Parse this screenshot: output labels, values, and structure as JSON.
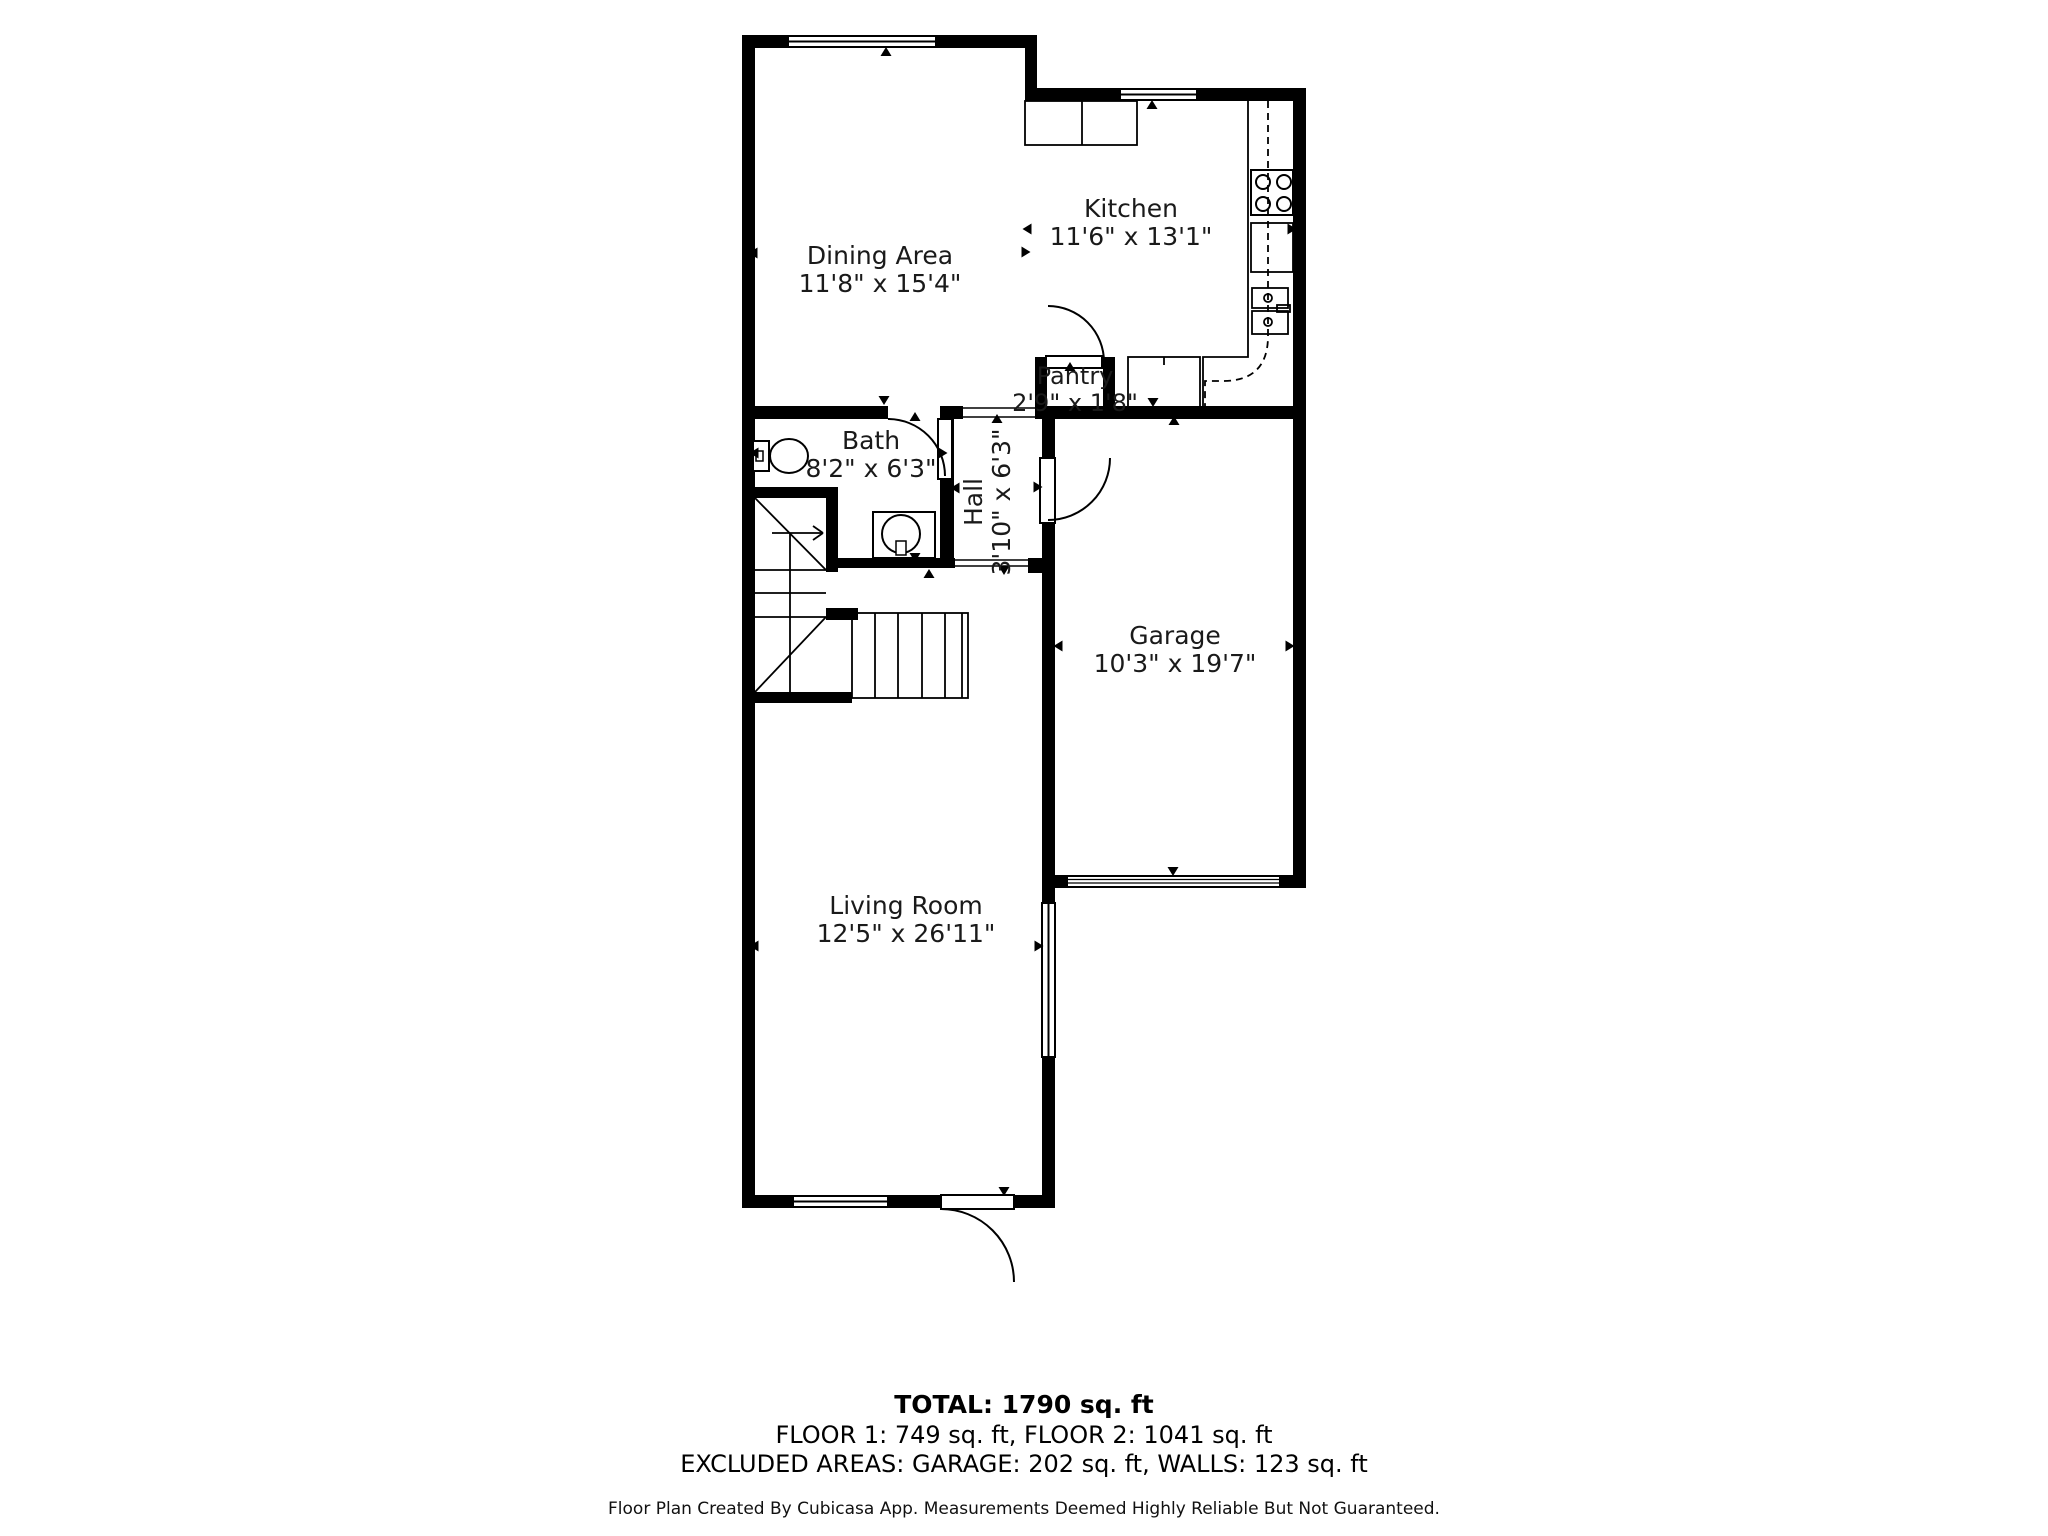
{
  "rooms": [
    {
      "name": "Dining Area",
      "dims": "11'8\" x 15'4\""
    },
    {
      "name": "Kitchen",
      "dims": "11'6\" x 13'1\""
    },
    {
      "name": "Pantry",
      "dims": "2'9\" x 1'8\""
    },
    {
      "name": "Bath",
      "dims": "8'2\" x 6'3\""
    },
    {
      "name": "Hall",
      "dims": "3'10\" x 6'3\""
    },
    {
      "name": "Garage",
      "dims": "10'3\" x 19'7\""
    },
    {
      "name": "Living Room",
      "dims": "12'5\" x 26'11\""
    }
  ],
  "summary": {
    "total": "TOTAL: 1790 sq. ft",
    "floors": "FLOOR 1: 749 sq. ft, FLOOR 2: 1041 sq. ft",
    "excluded": "EXCLUDED AREAS: GARAGE: 202 sq. ft, WALLS: 123 sq. ft"
  },
  "footer": "Floor Plan Created By Cubicasa App. Measurements Deemed Highly Reliable But Not Guaranteed.",
  "colors": {
    "wall": "#000000",
    "background": "#ffffff",
    "text": "#1a1a1a"
  }
}
